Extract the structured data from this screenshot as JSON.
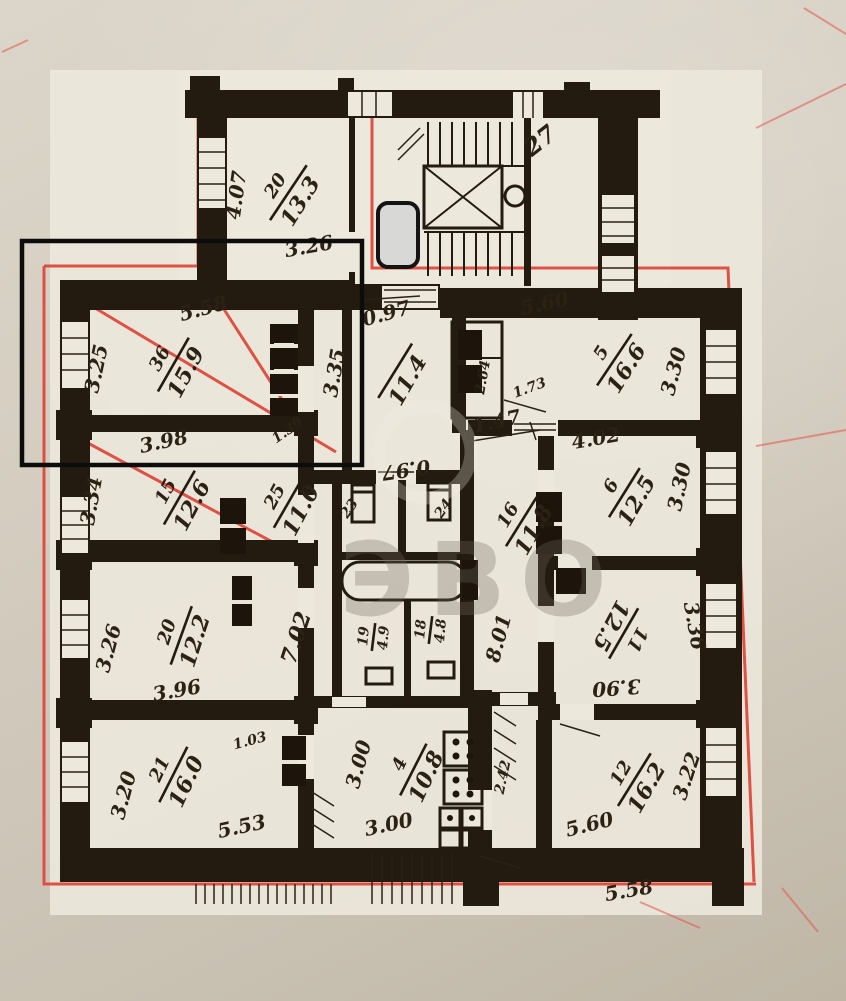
{
  "palette": {
    "paper": "#d3ccbf",
    "plan_paper": "#ece8dc",
    "ink": "#241b10",
    "red_line": "#dc453a",
    "marker_fill": "#d8d8d6",
    "marker_border": "#141414",
    "selection_color": "#0c0c0c",
    "watermark": "#6f685e"
  },
  "watermark": {
    "text": "ЭВО"
  },
  "stairwell": {
    "label": "27"
  },
  "outer": {
    "bottom_dimension": "5.58"
  },
  "rooms": {
    "r20_top": {
      "number": "20",
      "area": "13.3",
      "side": "4.07",
      "width": "3.26"
    },
    "r36": {
      "number": "36",
      "area": "15.9",
      "width": "5.58",
      "side": "3.25"
    },
    "r15": {
      "number": "15",
      "area": "12.6",
      "width": "3.98",
      "side": "3.34"
    },
    "r20": {
      "number": "20",
      "area": "12.2",
      "width": "3.96",
      "side": "3.26"
    },
    "r21": {
      "number": "21",
      "area": "16.0",
      "width": "5.53",
      "side": "3.20",
      "door": "1.03"
    },
    "hall": {
      "area": "11.4",
      "top": "0.97",
      "side": "3.35",
      "bottom": "0.97",
      "door": "1.39"
    },
    "c25": {
      "number": "25",
      "area": "11.0"
    },
    "c7": {
      "area": "7.02"
    },
    "h16": {
      "number": "16",
      "area": "11.8",
      "top": "1.47",
      "side": "8.01",
      "wc_side": "2.64"
    },
    "r5": {
      "number": "5",
      "area": "16.6",
      "width": "5.60",
      "side": "3.30",
      "door": "1.73"
    },
    "r6": {
      "number": "6",
      "area": "12.5",
      "width": "4.02",
      "side": "3.30"
    },
    "r11": {
      "number": "11",
      "area": "12.5",
      "width": "3.90",
      "side": "3.36"
    },
    "r12": {
      "number": "12",
      "area": "16.2",
      "width": "5.60",
      "side": "3.22"
    },
    "kitchen": {
      "number": "4",
      "area": "10.8",
      "width": "3.00",
      "side": "3.00",
      "wall": "2.42"
    },
    "b19": {
      "number": "19",
      "area": "4.9"
    },
    "b18": {
      "number": "18",
      "area": "4.8"
    },
    "wc23": {
      "number": "23"
    },
    "wc24": {
      "number": "24"
    }
  }
}
